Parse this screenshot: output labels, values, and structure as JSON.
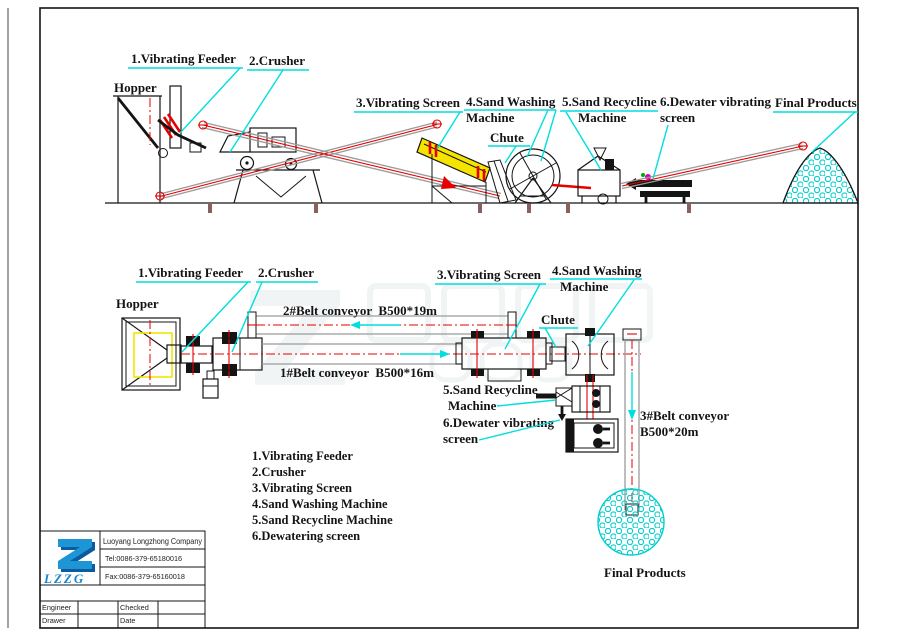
{
  "colors": {
    "leader_cyan": "#00dede",
    "centerline_red": "#e60000",
    "conveyor_gray": "#9b9b9b",
    "screen_yellow": "#f5e400",
    "sand_cyan": "#00cfcf",
    "logo_blue": "#1787cf",
    "line_black": "#141414"
  },
  "elevation": {
    "labels": {
      "hopper": "Hopper",
      "vibrating_feeder": "1.Vibrating Feeder",
      "crusher": "2.Crusher",
      "vibrating_screen": "3.Vibrating Screen",
      "sand_washing_line1": "4.Sand Washing",
      "sand_washing_line2": "Machine",
      "sand_recycline_line1": "5.Sand Recycline",
      "sand_recycline_line2": "Machine",
      "dewater_line1": "6.Dewater vibrating",
      "dewater_line2": "screen",
      "chute": "Chute",
      "final_products": "Final Products"
    }
  },
  "plan": {
    "labels": {
      "hopper": "Hopper",
      "vibrating_feeder": "1.Vibrating Feeder",
      "crusher": "2.Crusher",
      "belt2": "2#Belt conveyor  B500*19m",
      "belt1": "1#Belt conveyor  B500*16m",
      "vibrating_screen": "3.Vibrating Screen",
      "sand_washing_line1": "4.Sand Washing",
      "sand_washing_line2": "Machine",
      "chute": "Chute",
      "sand_recycline_line1": "5.Sand Recycline",
      "sand_recycline_line2": "Machine",
      "dewater_line1": "6.Dewater vibrating",
      "dewater_line2": "screen",
      "belt3_line1": "3#Belt conveyor",
      "belt3_line2": "B500*20m",
      "final_products": "Final Products"
    }
  },
  "legend": {
    "items": [
      "1.Vibrating Feeder",
      "2.Crusher",
      "3.Vibrating Screen",
      "4.Sand Washing Machine",
      "5.Sand Recycline Machine",
      "6.Dewatering screen"
    ]
  },
  "title_block": {
    "logo_text": "LZZG",
    "company": "Luoyang Longzhong Company",
    "tel": "Tel:0086-379-65180016",
    "fax": "Fax:0086-379-65160018",
    "engineer_label": "Engineer",
    "checked_label": "Checked",
    "drawer_label": "Drawer",
    "date_label": "Date"
  }
}
